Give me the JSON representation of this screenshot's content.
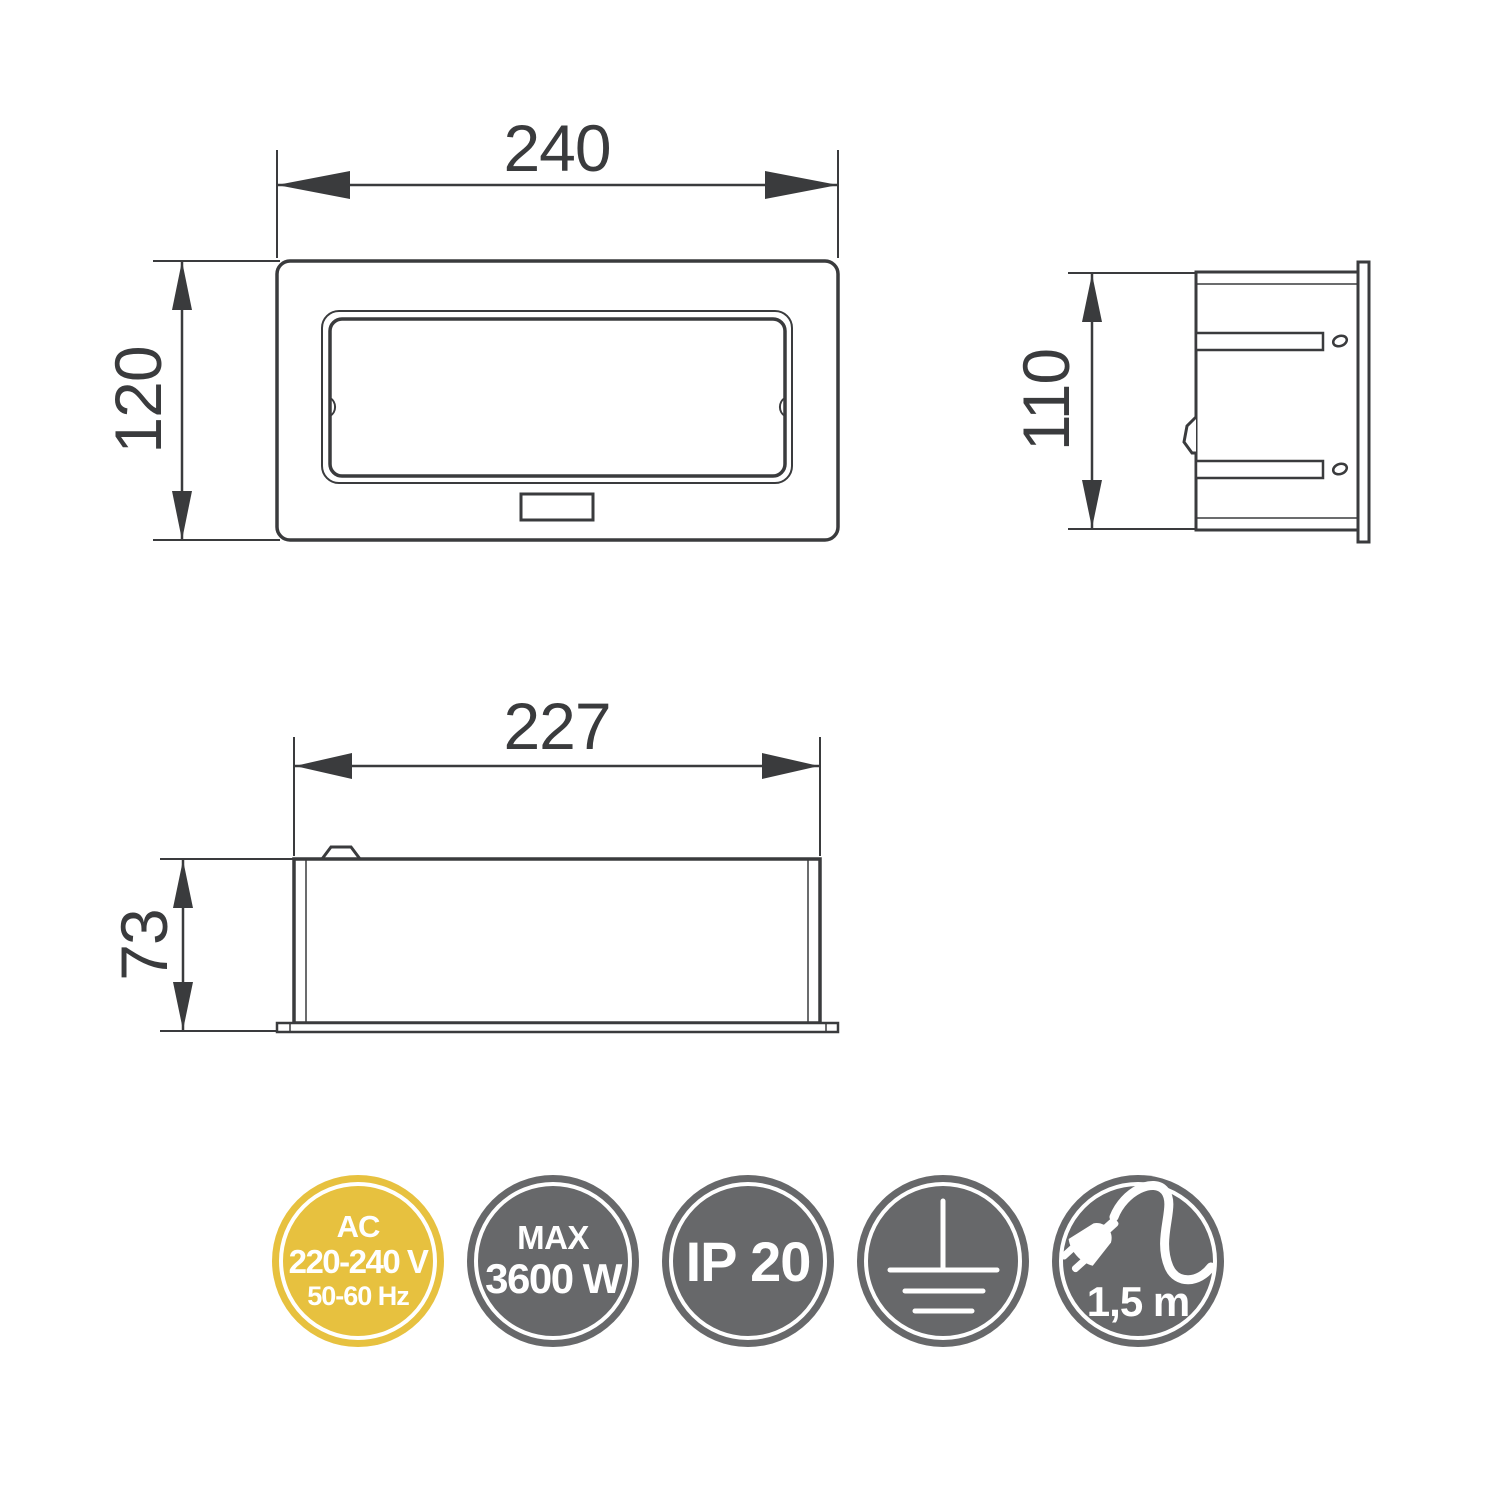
{
  "drawing": {
    "front_view": {
      "width_label": "240",
      "height_label": "120"
    },
    "side_view": {
      "height_label": "110"
    },
    "profile_view": {
      "width_label": "227",
      "height_label": "73"
    }
  },
  "badges": {
    "power": {
      "line1": "AC",
      "line2": "220-240 V",
      "line3": "50-60 Hz"
    },
    "max_load": {
      "line1": "MAX",
      "line2": "3600 W"
    },
    "ip_rating": {
      "label": "IP 20"
    },
    "grounding": {
      "icon": "grounding-symbol"
    },
    "cable": {
      "icon": "plug-with-cable",
      "label": "1,5 m"
    }
  },
  "colors": {
    "line": "#3a3b3d",
    "badge_yellow": "#e7c13f",
    "badge_gray": "#67686a",
    "badge_text": "#ffffff",
    "background": "#ffffff"
  }
}
